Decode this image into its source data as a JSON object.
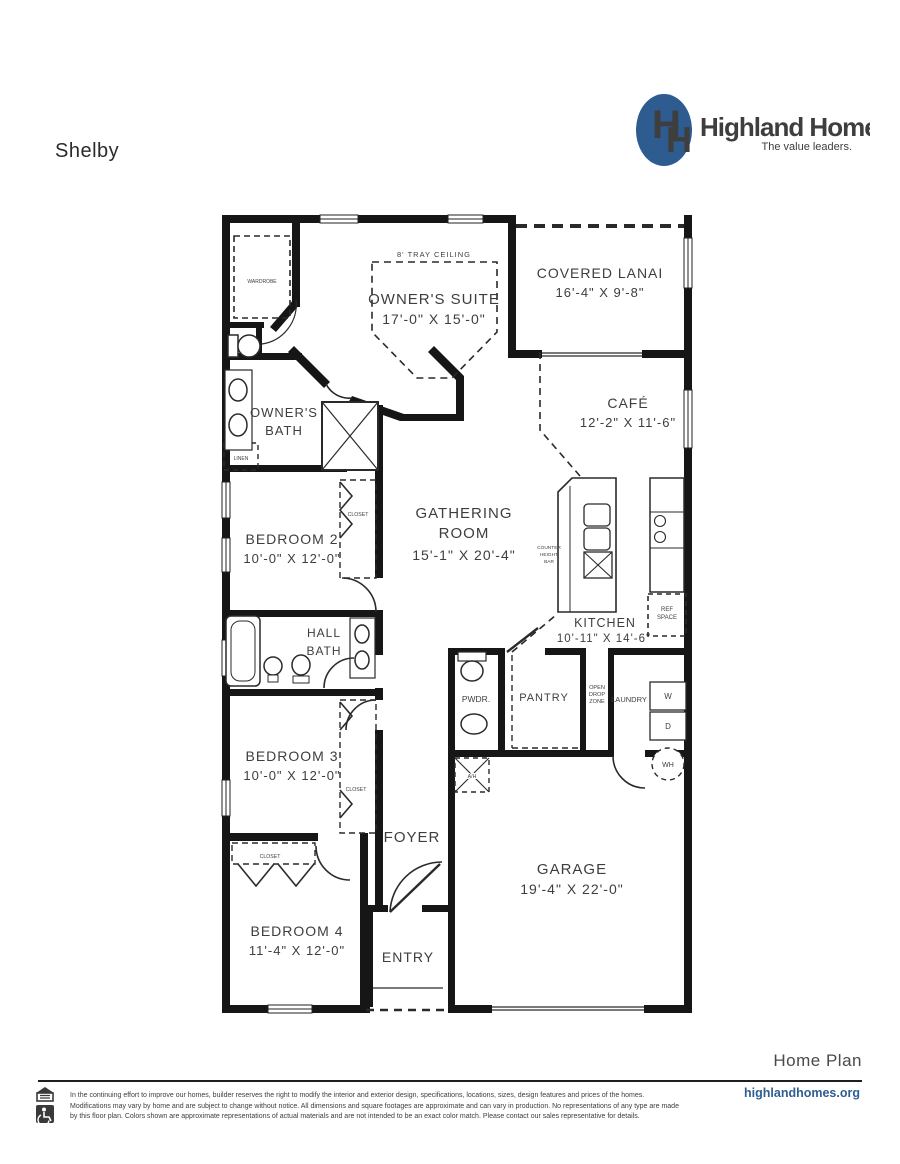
{
  "page": {
    "title": "Shelby"
  },
  "logo": {
    "monogram_left": "H",
    "monogram_right": "H",
    "brand": "Highland Homes",
    "tagline": "The value leaders.",
    "oval_color": "#2e5c90",
    "brand_color": "#1d4b80",
    "tagline_color": "#4472a8"
  },
  "plan": {
    "tray_label": "8' TRAY CEILING",
    "rooms": {
      "owners_suite": {
        "name": "OWNER'S SUITE",
        "dims": "17'-0\" X 15'-0\""
      },
      "covered_lanai": {
        "name": "COVERED LANAI",
        "dims": "16'-4\" X 9'-8\""
      },
      "cafe": {
        "name": "CAFÉ",
        "dims": "12'-2\" X 11'-6\""
      },
      "gathering": {
        "name1": "GATHERING",
        "name2": "ROOM",
        "dims": "15'-1\" X 20'-4\""
      },
      "kitchen": {
        "name": "KITCHEN",
        "dims": "10'-11\" X 14'-6\""
      },
      "owners_bath": {
        "name1": "OWNER'S",
        "name2": "BATH"
      },
      "hall_bath": {
        "name1": "HALL",
        "name2": "BATH"
      },
      "bedroom2": {
        "name": "BEDROOM 2",
        "dims": "10'-0\" X 12'-0\""
      },
      "bedroom3": {
        "name": "BEDROOM 3",
        "dims": "10'-0\" X 12'-0\""
      },
      "bedroom4": {
        "name": "BEDROOM 4",
        "dims": "11'-4\" X 12'-0\""
      },
      "garage": {
        "name": "GARAGE",
        "dims": "19'-4\" X 22'-0\""
      },
      "foyer": "FOYER",
      "entry": "ENTRY",
      "pwdr": "PWDR.",
      "pantry": "PANTRY",
      "laundry": "LAUNDRY",
      "drop_zone": {
        "l1": "OPEN",
        "l2": "DROP",
        "l3": "ZONE"
      },
      "counter_bar": {
        "l1": "COUNTER",
        "l2": "HEIGHT",
        "l3": "BAR"
      },
      "ref_space": {
        "l1": "REF",
        "l2": "SPACE"
      },
      "washer": "W",
      "dryer": "D",
      "water_heater": "WH",
      "air_handler": "A/H",
      "wardrobe": "WARDROBE",
      "linen": "LINEN",
      "closet": "CLOSET"
    }
  },
  "footer": {
    "home_plan": "Home Plan",
    "website": "highlandhomes.org",
    "disclaimer": "In the continuing effort to improve our homes, builder reserves the right to modify the interior and exterior design, specifications, locations, sizes, design features and prices of the homes. Modifications may vary by home and are subject to change without notice. All dimensions and square footages are approximate and can vary in production. No representations of any type are made by this floor plan. Colors shown are approximate representations of actual materials and are not intended to be an exact color match. Please contact our sales representative for details."
  }
}
